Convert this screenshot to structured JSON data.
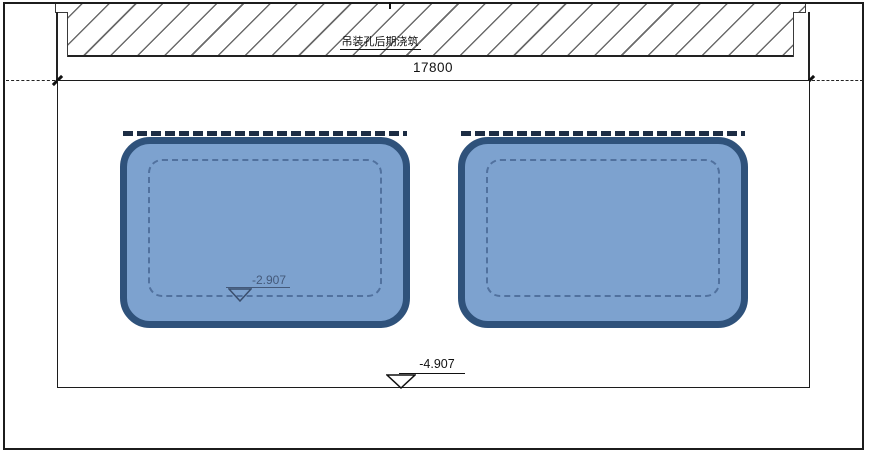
{
  "drawing": {
    "note": "吊装孔后期浇筑",
    "dimension": "17800",
    "elevations": {
      "pit": "-2.907",
      "base": "-4.907"
    },
    "colors": {
      "pool_fill": "#7da2cf",
      "pool_border": "#2f527b",
      "pool_inner_dash": "#51719e",
      "line": "#1c1c1c",
      "elevation_pit_text": "#44597a"
    }
  }
}
